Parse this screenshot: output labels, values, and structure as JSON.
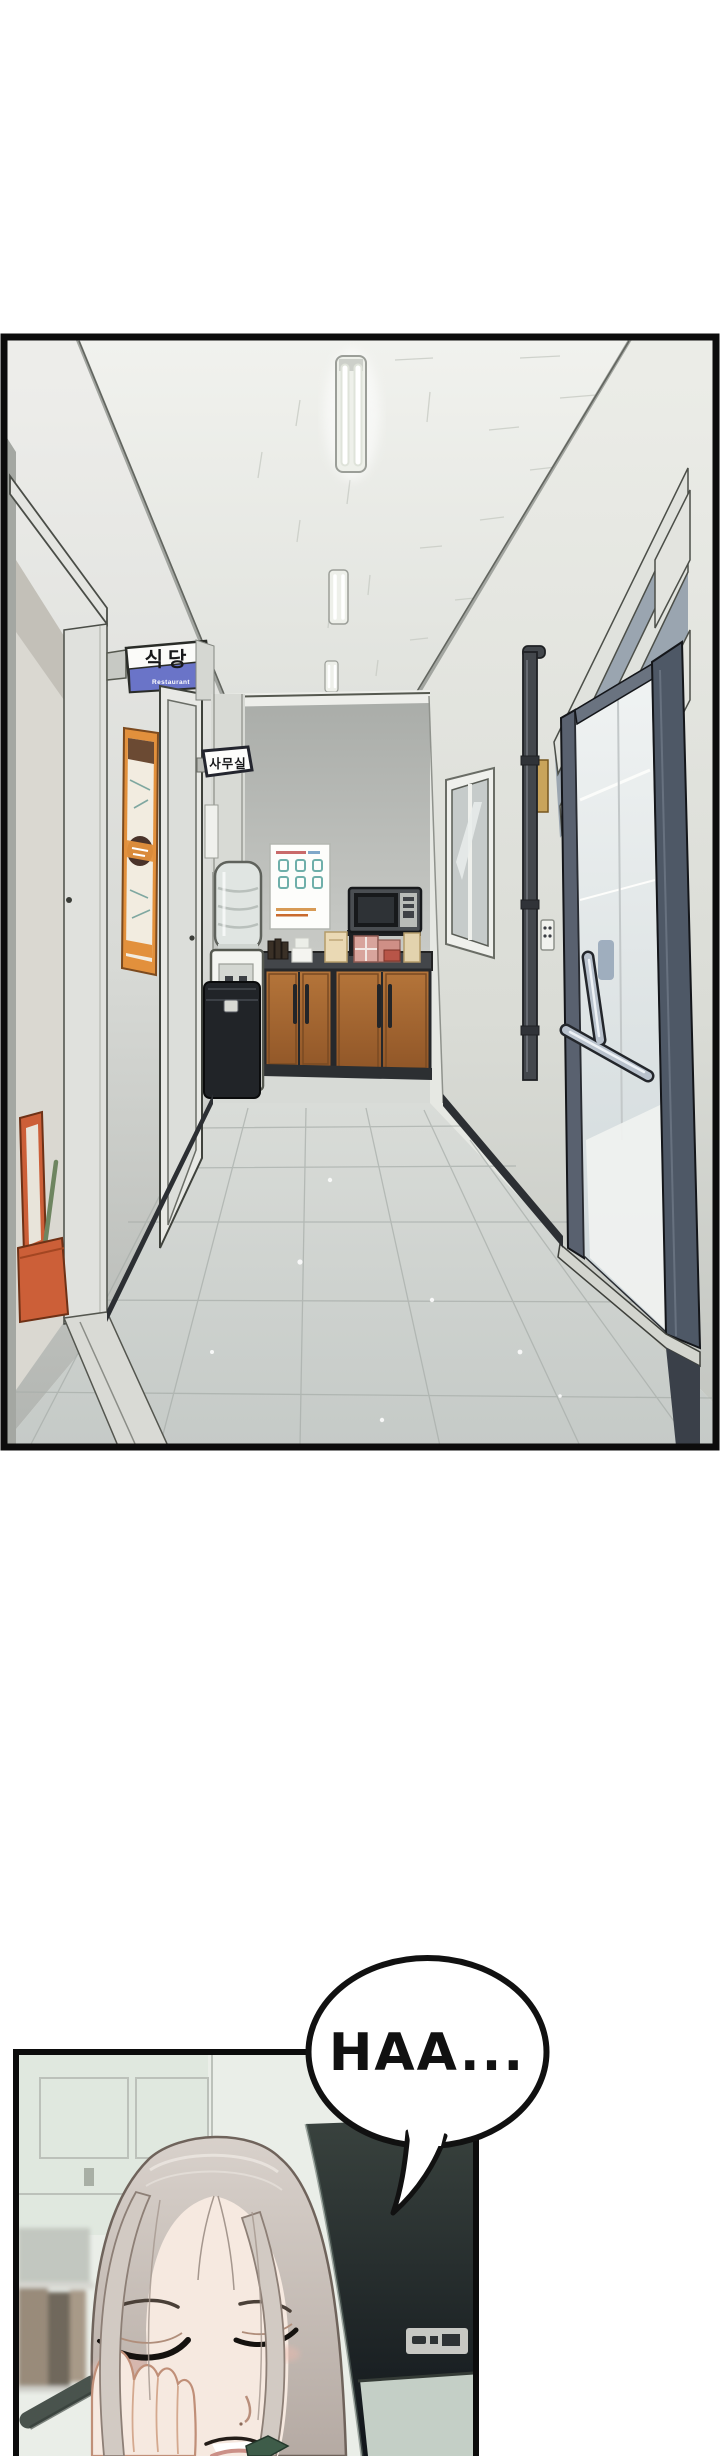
{
  "comic": {
    "bubble": {
      "text": "HAA..."
    },
    "panel1": {
      "restaurant_sign": {
        "kr": "식당",
        "en": "Restaurant"
      },
      "office_sign": {
        "kr": "사무실"
      }
    },
    "palette": {
      "page_bg": "#ffffff",
      "panel_border": "#0c0c0c",
      "wall_light": "#e7e8e4",
      "floor_gray": "#ccd1ce",
      "sign_blue": "#6a74c8",
      "poster_orange": "#e2903c",
      "cabinet_wood": "#a96a33",
      "bin_black": "#212428",
      "pipe_gray": "#43474c",
      "door_frame_blue_gray": "#59616f",
      "stand_orange": "#cc5f38",
      "monitor_dark": "#20282a",
      "hair_silver": "#d2cac3",
      "skin": "#f6e9e0",
      "blush": "#edb9ad",
      "collar_green": "#3e5c49",
      "bubble_fill": "#ffffff",
      "bubble_text": "#111111"
    }
  }
}
